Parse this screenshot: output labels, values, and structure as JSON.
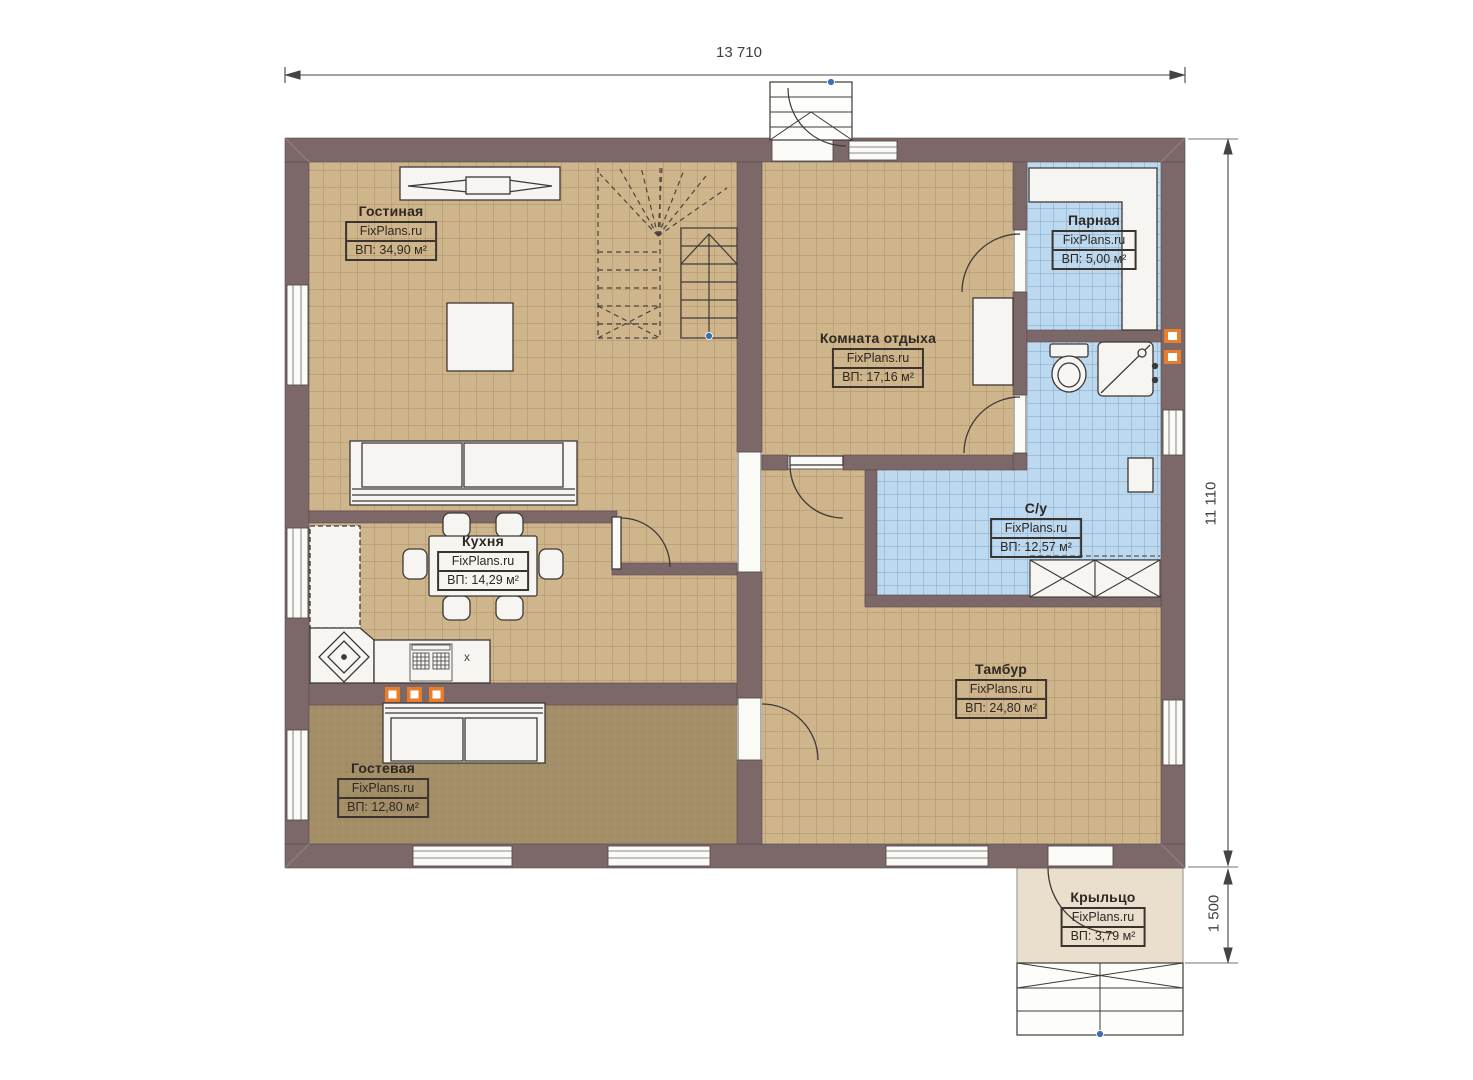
{
  "plan": {
    "brand": "FixPlans.ru",
    "dimensions": {
      "width": "13 710",
      "height": "11 110",
      "porch_depth": "1 500"
    },
    "rooms": [
      {
        "name": "Гостиная",
        "brand": "FixPlans.ru",
        "area": "ВП: 34,90 м²"
      },
      {
        "name": "Комната отдыха",
        "brand": "FixPlans.ru",
        "area": "ВП: 17,16 м²"
      },
      {
        "name": "Парная",
        "brand": "FixPlans.ru",
        "area": "ВП: 5,00 м²"
      },
      {
        "name": "Кухня",
        "brand": "FixPlans.ru",
        "area": "ВП: 14,29 м²"
      },
      {
        "name": "С/у",
        "brand": "FixPlans.ru",
        "area": "ВП: 12,57 м²"
      },
      {
        "name": "Тамбур",
        "brand": "FixPlans.ru",
        "area": "ВП: 24,80 м²"
      },
      {
        "name": "Гостевая",
        "brand": "FixPlans.ru",
        "area": "ВП: 12,80 м²"
      },
      {
        "name": "Крыльцо",
        "brand": "FixPlans.ru",
        "area": "ВП: 3,79 м²"
      }
    ],
    "stove_label": "x",
    "colors": {
      "wall": "#7c6769",
      "tile_tan": "#cfb58c",
      "tile_blue": "#bcd9ef",
      "carpet_brown": "#a38e68",
      "porch_beige": "#e9dfcc",
      "accent_orange": "#e87e2c",
      "marker_blue": "#3d6db3"
    }
  }
}
